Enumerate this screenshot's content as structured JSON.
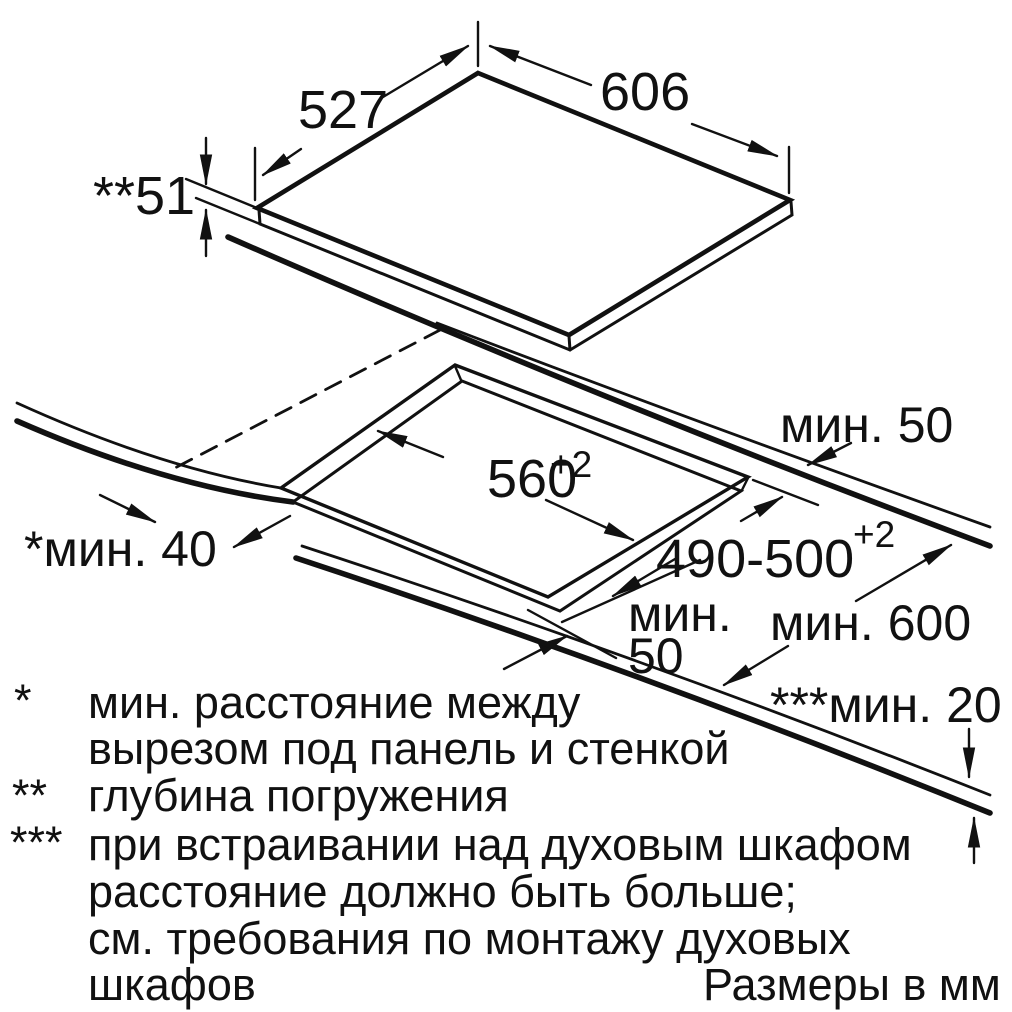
{
  "diagram": {
    "title_units": "Размеры в мм",
    "dimensions": {
      "panel_depth": "527",
      "panel_width": "606",
      "panel_thickness": "**51",
      "wall_clearance_back": "мин. 50",
      "side_clearance": "*мин. 40",
      "cutout_width": "560",
      "cutout_width_tolerance": "+2",
      "cutout_depth": "490-500",
      "cutout_depth_tolerance": "+2",
      "front_gap_line1": "мин.",
      "front_gap_line2": "50",
      "worktop_min_depth": "мин. 600",
      "oven_clearance": "***мин. 20"
    },
    "footnotes": {
      "marker1": "*",
      "line1a": "мин. расстояние между",
      "line1b": "вырезом под панель и стенкой",
      "marker2": "**",
      "line2a": "глубина погружения",
      "marker3": "***",
      "line3a": "при встраивании над духовым шкафом",
      "line3b": "расстояние должно быть больше;",
      "line3c": "см. требования по монтажу духовых",
      "line3d": "шкафов"
    }
  }
}
